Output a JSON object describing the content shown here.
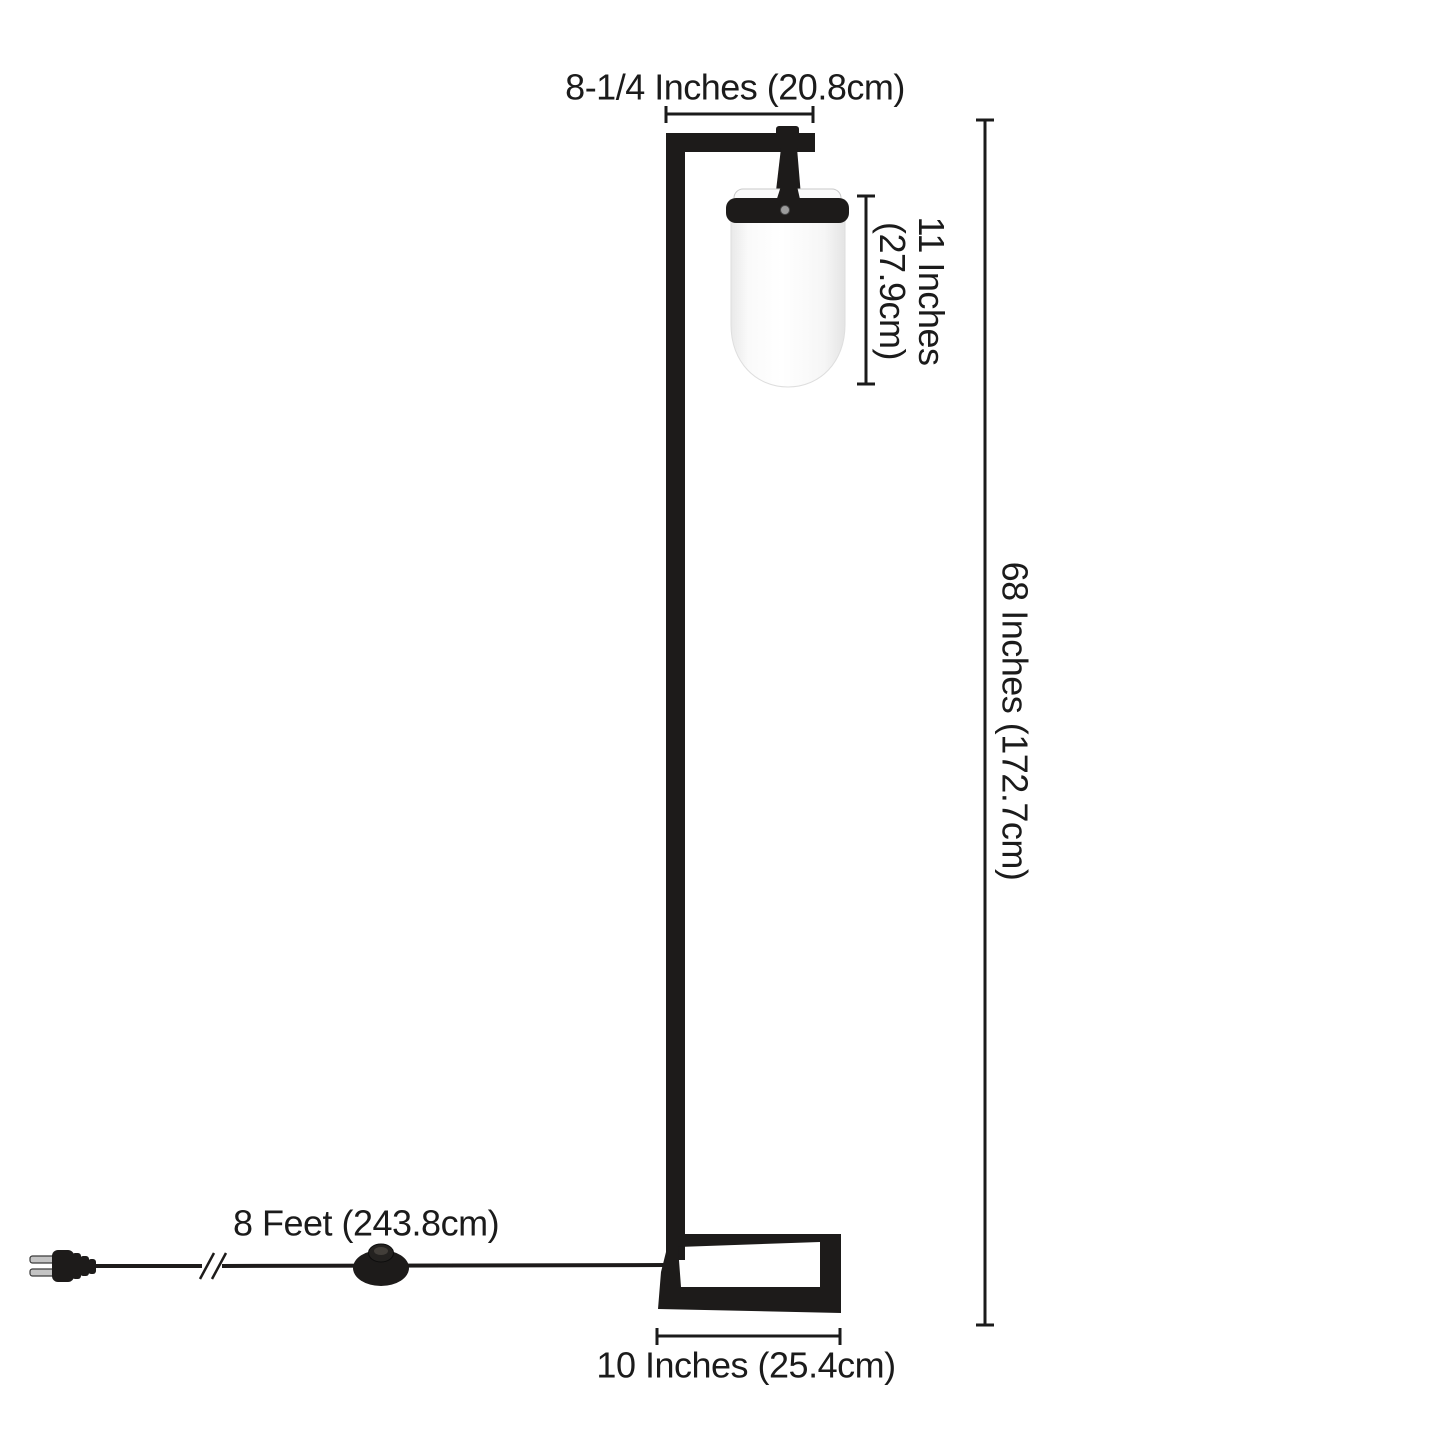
{
  "diagram_labels": {
    "shade_width": "8-1/4 Inches (20.8cm)",
    "shade_height_line1": "11 Inches",
    "shade_height_line2": "(27.9cm)",
    "lamp_height": "68 Inches (172.7cm)",
    "cord_length": "8 Feet (243.8cm)",
    "base_width": "10 Inches (25.4cm)"
  },
  "colors": {
    "ink": "#1b1b1b",
    "frame_black": "#1d1b1a",
    "shade_white": "#ffffff",
    "screw_gray": "#9c9c9c",
    "background": "#ffffff"
  }
}
